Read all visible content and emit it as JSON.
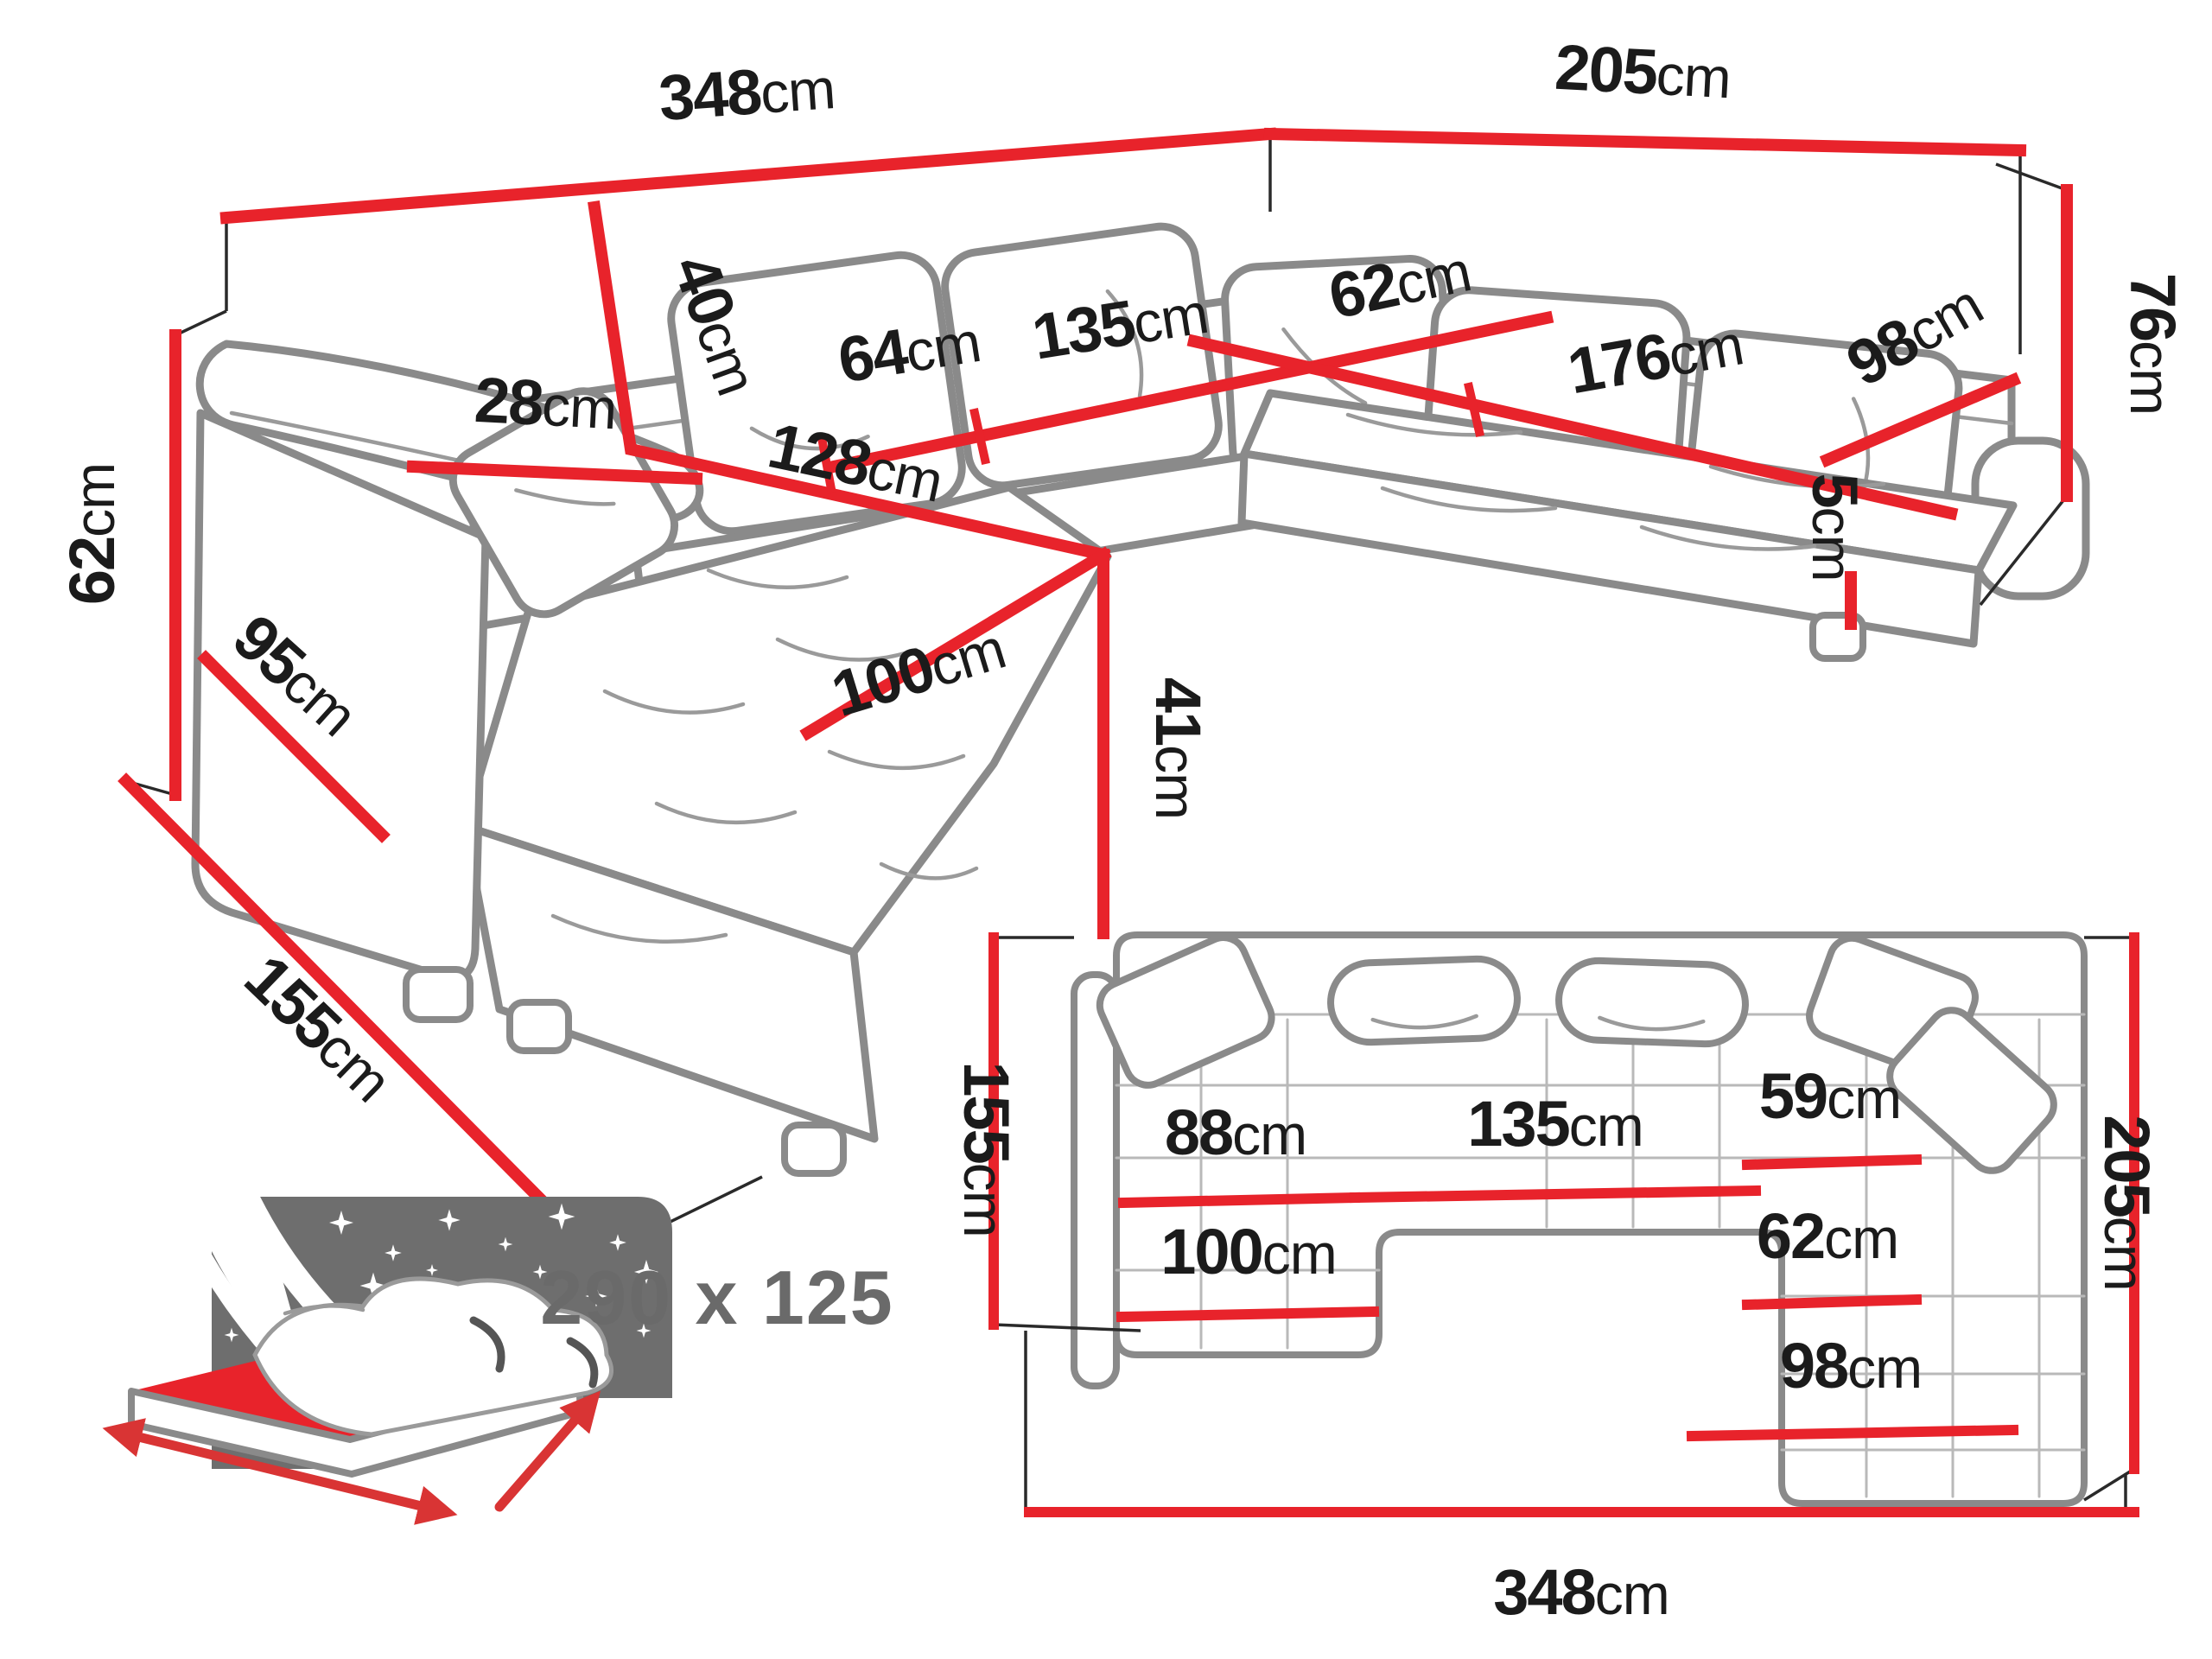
{
  "colors": {
    "dimension_red": "#e8232b",
    "sketch_gray": "#8a8a8a",
    "label_black": "#1b1b1b",
    "icon_gray": "#6e6e6e"
  },
  "persp": {
    "back_width": {
      "num": "348",
      "unit": "cm"
    },
    "right_back_width": {
      "num": "205",
      "unit": "cm"
    },
    "total_height": {
      "num": "76",
      "unit": "cm"
    },
    "arm_height": {
      "num": "62",
      "unit": "cm"
    },
    "arm_top_depth": {
      "num": "28",
      "unit": "cm"
    },
    "arm_side_length": {
      "num": "95",
      "unit": "cm"
    },
    "back_cushion_height": {
      "num": "40",
      "unit": "cm"
    },
    "seat_depth_left": {
      "num": "64",
      "unit": "cm"
    },
    "seat_width_mid": {
      "num": "135",
      "unit": "cm"
    },
    "chaise_length": {
      "num": "128",
      "unit": "cm"
    },
    "chaise_width": {
      "num": "100",
      "unit": "cm"
    },
    "seat_height": {
      "num": "41",
      "unit": "cm"
    },
    "seat_depth_right": {
      "num": "62",
      "unit": "cm"
    },
    "seat_width_right": {
      "num": "176",
      "unit": "cm"
    },
    "right_section_depth": {
      "num": "98",
      "unit": "cm"
    },
    "leg_height": {
      "num": "5",
      "unit": "cm"
    },
    "chaise_total_depth": {
      "num": "155",
      "unit": "cm"
    }
  },
  "top": {
    "depth_left": {
      "num": "155",
      "unit": "cm"
    },
    "chaise_seat_width": {
      "num": "88",
      "unit": "cm"
    },
    "mid_seat_width": {
      "num": "135",
      "unit": "cm"
    },
    "right_seat_width": {
      "num": "59",
      "unit": "cm"
    },
    "right_section_width": {
      "num": "62",
      "unit": "cm"
    },
    "chaise_width": {
      "num": "100",
      "unit": "cm"
    },
    "right_section_bottom": {
      "num": "98",
      "unit": "cm"
    },
    "depth_right": {
      "num": "205",
      "unit": "cm"
    },
    "total_width": {
      "num": "348",
      "unit": "cm"
    }
  },
  "bed": {
    "sleeping_area": "290 x 125"
  }
}
